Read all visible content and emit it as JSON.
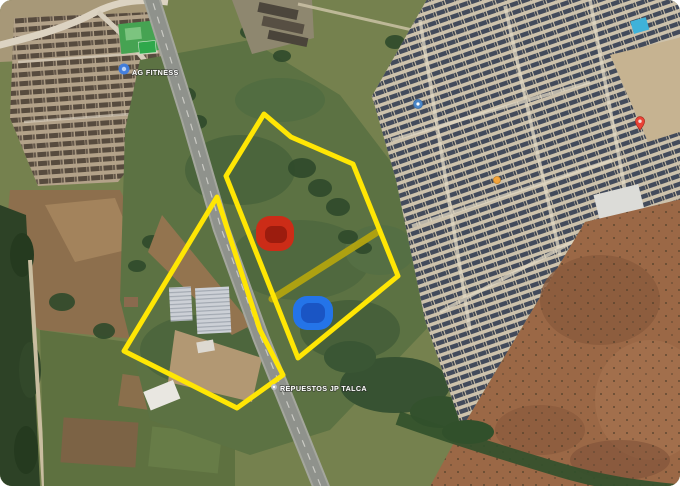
{
  "image": {
    "description": "Satellite aerial map with two land parcels outlined in yellow beside a highway, a red and a blue area marker, and map place labels",
    "width": 680,
    "height": 486,
    "corner_radius": 12
  },
  "map_labels": {
    "fitness": {
      "text": "AG FITNESS",
      "x": 132,
      "y": 75,
      "color": "#ffffff",
      "icon": {
        "x": 124,
        "y": 69,
        "r": 5.5,
        "fill": "#3f7de0",
        "inner_fill": "#bcd3f5",
        "inner_r": 2.2
      }
    },
    "repuestos": {
      "text": "REPUESTOS JP TALCA",
      "x": 280,
      "y": 391,
      "color": "#ffffff",
      "icon": {
        "x": 274,
        "y": 387,
        "r": 3,
        "fill": "#b9bfc6",
        "inner_fill": "#ffffff",
        "inner_r": 1.2
      }
    }
  },
  "map_pins": [
    {
      "name": "red-map-pin",
      "type": "pin",
      "x": 640,
      "y": 130,
      "color": "#ea4335"
    },
    {
      "name": "orange-poi-dot",
      "type": "dot",
      "x": 497,
      "y": 180,
      "r": 3.5,
      "color": "#f2a43d",
      "rim": "#c77f1f"
    },
    {
      "name": "blue-poi-dot",
      "type": "dot",
      "x": 418,
      "y": 104,
      "r": 4.5,
      "color": "#4a86c8",
      "rim": "#3b6ea8"
    }
  ],
  "overlay": {
    "boundary_color": "#ffe604",
    "boundary_width": 5,
    "parcels": [
      {
        "name": "parcel-boundary-east",
        "points": "264,114 291,137 353,164 398,276 298,358 226,176"
      },
      {
        "name": "parcel-boundary-west",
        "points": "217,197 260,330 283,375 237,408 124,351"
      }
    ],
    "connector": {
      "x1": 272,
      "y1": 299,
      "x2": 379,
      "y2": 231,
      "color": "#b3a40f",
      "width": 7
    },
    "markers": [
      {
        "name": "red-area-marker",
        "x": 256,
        "y": 216,
        "w": 38,
        "h": 35,
        "rx": 14,
        "fill": "#cc2c17",
        "inner": {
          "x": 265,
          "y": 226,
          "w": 22,
          "h": 17,
          "rx": 7,
          "fill": "#9c1c0e"
        }
      },
      {
        "name": "blue-area-marker",
        "x": 293,
        "y": 296,
        "w": 40,
        "h": 34,
        "rx": 14,
        "fill": "#2474e8",
        "inner": {
          "x": 301,
          "y": 303,
          "w": 24,
          "h": 20,
          "rx": 8,
          "fill": "#1a55c4"
        }
      }
    ]
  }
}
